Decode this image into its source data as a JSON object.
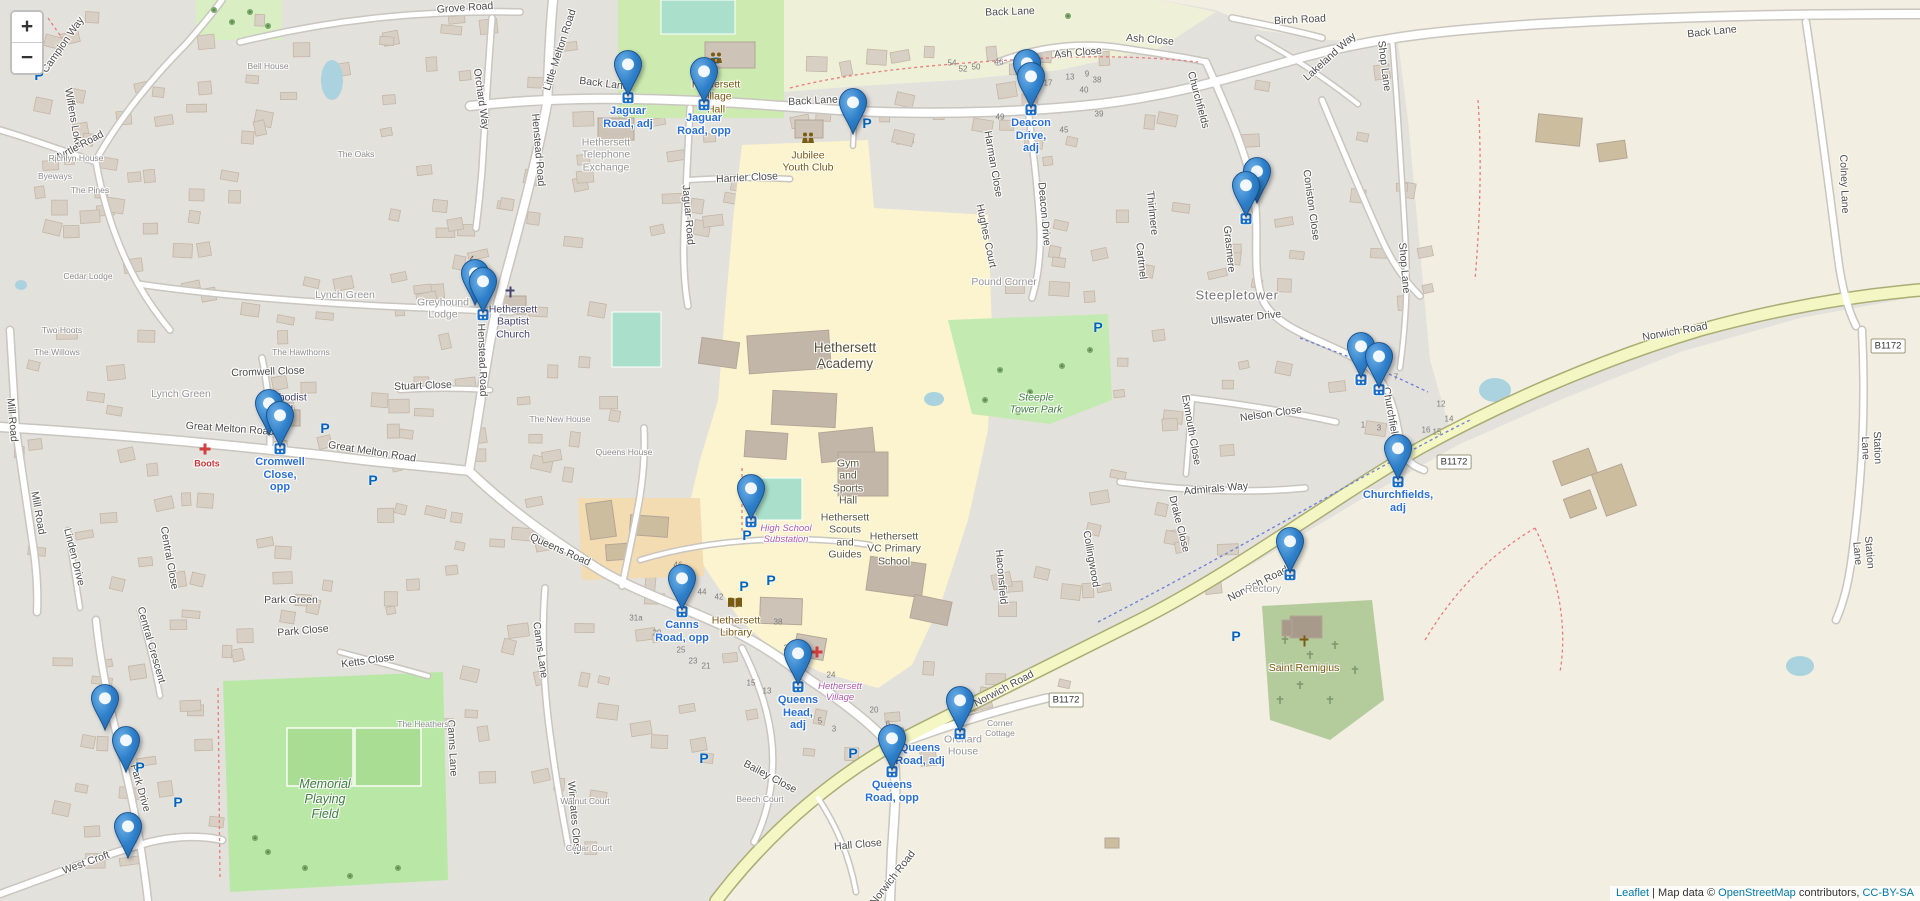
{
  "controls": {
    "zoom_in": "+",
    "zoom_out": "−"
  },
  "attribution": {
    "leaflet": "Leaflet",
    "separator": " | ",
    "prefix": "Map data © ",
    "osm": "OpenStreetMap",
    "contributors": " contributors, ",
    "license": "CC-BY-SA"
  },
  "colors": {
    "marker_blue": "#2a81cb",
    "marker_label_blue": "#2a6fd6",
    "link_blue": "#0078a8",
    "road_b_yellow": "#f4f6c3"
  },
  "markers": [
    {
      "id": "jaguar-road-adj",
      "x": 628,
      "y": 102,
      "bus": true,
      "label": "Jaguar\nRoad, adj"
    },
    {
      "id": "jaguar-road-opp",
      "x": 704,
      "y": 109,
      "bus": true,
      "label": "Jaguar\nRoad, opp"
    },
    {
      "id": "back-lane-car-park",
      "x": 853,
      "y": 140,
      "bus": false,
      "label": ""
    },
    {
      "id": "deacon-drive-rear",
      "x": 1027,
      "y": 101,
      "bus": false,
      "label": ""
    },
    {
      "id": "deacon-drive-adj",
      "x": 1031,
      "y": 114,
      "bus": true,
      "label": "Deacon\nDrive,\nadj"
    },
    {
      "id": "coniston-close-1",
      "x": 1257,
      "y": 209,
      "bus": false,
      "label": ""
    },
    {
      "id": "coniston-close-2",
      "x": 1246,
      "y": 223,
      "bus": true,
      "label": ""
    },
    {
      "id": "baptist-church-1",
      "x": 475,
      "y": 311,
      "bus": false,
      "label": ""
    },
    {
      "id": "baptist-church-2",
      "x": 483,
      "y": 319,
      "bus": true,
      "label": ""
    },
    {
      "id": "cromwell-close-rear",
      "x": 269,
      "y": 441,
      "bus": false,
      "label": ""
    },
    {
      "id": "cromwell-close-opp",
      "x": 280,
      "y": 453,
      "bus": true,
      "label": "Cromwell\nClose,\nopp"
    },
    {
      "id": "churchfields-1",
      "x": 1361,
      "y": 384,
      "bus": true,
      "label": ""
    },
    {
      "id": "churchfields-2",
      "x": 1379,
      "y": 394,
      "bus": true,
      "label": ""
    },
    {
      "id": "churchfields-adj",
      "x": 1398,
      "y": 486,
      "bus": true,
      "label": "Churchfields,\nadj"
    },
    {
      "id": "high-school",
      "x": 751,
      "y": 526,
      "bus": true,
      "label": ""
    },
    {
      "id": "canns-road-opp",
      "x": 682,
      "y": 616,
      "bus": true,
      "label": "Canns\nRoad, opp"
    },
    {
      "id": "norwich-road",
      "x": 1290,
      "y": 579,
      "bus": true,
      "label": ""
    },
    {
      "id": "queens-head-adj",
      "x": 798,
      "y": 691,
      "bus": true,
      "label": "Queens\nHead,\nadj"
    },
    {
      "id": "queens-road-adj",
      "x": 960,
      "y": 738,
      "bus": true,
      "label": "Queens\nRoad, adj",
      "lx": 920,
      "ly": 742
    },
    {
      "id": "queens-road-opp",
      "x": 892,
      "y": 776,
      "bus": true,
      "label": "Queens\nRoad, opp"
    },
    {
      "id": "park-drive-1",
      "x": 105,
      "y": 736,
      "bus": false,
      "label": ""
    },
    {
      "id": "park-drive-2",
      "x": 126,
      "y": 778,
      "bus": false,
      "label": ""
    },
    {
      "id": "west-croft",
      "x": 128,
      "y": 864,
      "bus": false,
      "label": ""
    }
  ],
  "labels": [
    {
      "t": "Grove Road",
      "x": 465,
      "y": 8,
      "r": -4,
      "c": "st"
    },
    {
      "t": "Back Lane",
      "x": 604,
      "y": 84,
      "r": 7,
      "c": "st"
    },
    {
      "t": "Back Lane",
      "x": 813,
      "y": 101,
      "r": -3,
      "c": "st"
    },
    {
      "t": "Back Lane",
      "x": 1010,
      "y": 12,
      "r": -2,
      "c": "st"
    },
    {
      "t": "Back Lane",
      "x": 1712,
      "y": 32,
      "r": -6,
      "c": "st"
    },
    {
      "t": "Campion Way",
      "x": 63,
      "y": 45,
      "r": -55,
      "c": "st"
    },
    {
      "t": "Wiffens Loke",
      "x": 73,
      "y": 118,
      "r": 80,
      "c": "st"
    },
    {
      "t": "Myrtle Road",
      "x": 78,
      "y": 147,
      "r": -28,
      "c": "st"
    },
    {
      "t": "Orchard Way",
      "x": 481,
      "y": 99,
      "r": 82,
      "c": "st"
    },
    {
      "t": "Little Melton Road",
      "x": 560,
      "y": 50,
      "r": -72,
      "c": "st"
    },
    {
      "t": "Henstead Road",
      "x": 538,
      "y": 150,
      "r": 85,
      "c": "st"
    },
    {
      "t": "Henstead Road",
      "x": 482,
      "y": 360,
      "r": 88,
      "c": "st"
    },
    {
      "t": "Jaguar Road",
      "x": 688,
      "y": 215,
      "r": 85,
      "c": "st"
    },
    {
      "t": "Harrier Close",
      "x": 747,
      "y": 178,
      "r": -3,
      "c": "st"
    },
    {
      "t": "Lynch Green",
      "x": 345,
      "y": 295,
      "r": 0,
      "c": "ar"
    },
    {
      "t": "Lynch Green",
      "x": 181,
      "y": 394,
      "r": 0,
      "c": "ar"
    },
    {
      "t": "Stuart Close",
      "x": 423,
      "y": 386,
      "r": -2,
      "c": "st"
    },
    {
      "t": "Cromwell Close",
      "x": 268,
      "y": 372,
      "r": -2,
      "c": "st"
    },
    {
      "t": "Great Melton Road",
      "x": 230,
      "y": 429,
      "r": 4,
      "c": "st"
    },
    {
      "t": "Great Melton Road",
      "x": 372,
      "y": 452,
      "r": 9,
      "c": "st"
    },
    {
      "t": "Mill Road",
      "x": 12,
      "y": 420,
      "r": 85,
      "c": "st"
    },
    {
      "t": "Mill Road",
      "x": 38,
      "y": 513,
      "r": 80,
      "c": "st"
    },
    {
      "t": "Queens Road",
      "x": 560,
      "y": 550,
      "r": 24,
      "c": "st"
    },
    {
      "t": "Canns Lane",
      "x": 540,
      "y": 650,
      "r": 82,
      "c": "st"
    },
    {
      "t": "Canns Lane",
      "x": 452,
      "y": 748,
      "r": 87,
      "c": "st"
    },
    {
      "t": "Ketts Close",
      "x": 368,
      "y": 661,
      "r": -8,
      "c": "st"
    },
    {
      "t": "Park Green",
      "x": 291,
      "y": 600,
      "r": 0,
      "c": "st"
    },
    {
      "t": "Park Close",
      "x": 303,
      "y": 631,
      "r": -5,
      "c": "st"
    },
    {
      "t": "Central Crescent",
      "x": 151,
      "y": 645,
      "r": 74,
      "c": "st"
    },
    {
      "t": "Central Close",
      "x": 169,
      "y": 558,
      "r": 80,
      "c": "st"
    },
    {
      "t": "Linden Drive",
      "x": 74,
      "y": 557,
      "r": 76,
      "c": "st"
    },
    {
      "t": "Park Drive",
      "x": 140,
      "y": 788,
      "r": 74,
      "c": "st"
    },
    {
      "t": "West Croft",
      "x": 86,
      "y": 863,
      "r": -20,
      "c": "st"
    },
    {
      "t": "Bailey Close",
      "x": 770,
      "y": 777,
      "r": 28,
      "c": "st"
    },
    {
      "t": "Hall Close",
      "x": 858,
      "y": 845,
      "r": -5,
      "c": "st"
    },
    {
      "t": "Wingates Close",
      "x": 574,
      "y": 818,
      "r": 85,
      "c": "st"
    },
    {
      "t": "Norwich Road",
      "x": 893,
      "y": 878,
      "r": -52,
      "c": "st"
    },
    {
      "t": "Norwich Road",
      "x": 1004,
      "y": 689,
      "r": -28,
      "c": "st"
    },
    {
      "t": "Norwich Road",
      "x": 1258,
      "y": 584,
      "r": -27,
      "c": "st"
    },
    {
      "t": "Norwich Road",
      "x": 1675,
      "y": 332,
      "r": -10,
      "c": "st"
    },
    {
      "t": "Churchfields",
      "x": 1198,
      "y": 100,
      "r": 75,
      "c": "st"
    },
    {
      "t": "Churchfields",
      "x": 1391,
      "y": 416,
      "r": 80,
      "c": "st"
    },
    {
      "t": "Coniston Close",
      "x": 1311,
      "y": 205,
      "r": 82,
      "c": "st"
    },
    {
      "t": "Lakeland Way",
      "x": 1330,
      "y": 57,
      "r": -42,
      "c": "st"
    },
    {
      "t": "Birch Road",
      "x": 1300,
      "y": 20,
      "r": -3,
      "c": "st"
    },
    {
      "t": "Ash Close",
      "x": 1078,
      "y": 53,
      "r": -5,
      "c": "st"
    },
    {
      "t": "Ash Close",
      "x": 1150,
      "y": 40,
      "r": 5,
      "c": "st"
    },
    {
      "t": "Shop Lane",
      "x": 1384,
      "y": 66,
      "r": 83,
      "c": "st"
    },
    {
      "t": "Shop Lane",
      "x": 1404,
      "y": 268,
      "r": 85,
      "c": "st"
    },
    {
      "t": "Station Lane",
      "x": 1871,
      "y": 448,
      "r": 88,
      "c": "st"
    },
    {
      "t": "Station Lane",
      "x": 1863,
      "y": 553,
      "r": 85,
      "c": "st"
    },
    {
      "t": "Colney Lane",
      "x": 1844,
      "y": 184,
      "r": 88,
      "c": "st"
    },
    {
      "t": "Harman Close",
      "x": 993,
      "y": 164,
      "r": 80,
      "c": "st"
    },
    {
      "t": "Hughes Court",
      "x": 986,
      "y": 236,
      "r": 78,
      "c": "st"
    },
    {
      "t": "Deacon Drive",
      "x": 1044,
      "y": 214,
      "r": 85,
      "c": "st"
    },
    {
      "t": "Cartmel",
      "x": 1141,
      "y": 261,
      "r": 84,
      "c": "st"
    },
    {
      "t": "Thirlmere",
      "x": 1152,
      "y": 213,
      "r": 84,
      "c": "st"
    },
    {
      "t": "Grasmere",
      "x": 1229,
      "y": 249,
      "r": 84,
      "c": "st"
    },
    {
      "t": "Ullswater Drive",
      "x": 1246,
      "y": 318,
      "r": -6,
      "c": "st"
    },
    {
      "t": "Nelson Close",
      "x": 1271,
      "y": 414,
      "r": -8,
      "c": "st"
    },
    {
      "t": "Admirals Way",
      "x": 1216,
      "y": 489,
      "r": -5,
      "c": "st"
    },
    {
      "t": "Exmouth Close",
      "x": 1191,
      "y": 430,
      "r": 80,
      "c": "st"
    },
    {
      "t": "Drake Close",
      "x": 1179,
      "y": 524,
      "r": 76,
      "c": "st"
    },
    {
      "t": "Collingwood",
      "x": 1091,
      "y": 559,
      "r": 80,
      "c": "st"
    },
    {
      "t": "Haconsfield",
      "x": 1001,
      "y": 577,
      "r": 85,
      "c": "st"
    },
    {
      "t": "Rectory",
      "x": 1263,
      "y": 589,
      "r": 0,
      "c": "ar"
    },
    {
      "t": "Pound Corner",
      "x": 1004,
      "y": 282,
      "r": 0,
      "c": "ar"
    },
    {
      "t": "Steepletower",
      "x": 1237,
      "y": 295,
      "r": 0,
      "c": "loc"
    },
    {
      "t": "Bell House",
      "x": 268,
      "y": 66,
      "r": 0,
      "c": "hn"
    },
    {
      "t": "The Oaks",
      "x": 356,
      "y": 154,
      "r": 0,
      "c": "hn"
    },
    {
      "t": "Richlyn House",
      "x": 76,
      "y": 158,
      "r": 0,
      "c": "hn"
    },
    {
      "t": "The Pines",
      "x": 90,
      "y": 190,
      "r": 0,
      "c": "hn"
    },
    {
      "t": "Byeways",
      "x": 55,
      "y": 176,
      "r": 0,
      "c": "hn"
    },
    {
      "t": "Cedar Lodge",
      "x": 88,
      "y": 276,
      "r": 0,
      "c": "hn"
    },
    {
      "t": "Two Hoots",
      "x": 62,
      "y": 330,
      "r": 0,
      "c": "hn"
    },
    {
      "t": "The Willows",
      "x": 57,
      "y": 352,
      "r": 0,
      "c": "hn"
    },
    {
      "t": "The Hawthorns",
      "x": 301,
      "y": 352,
      "r": 0,
      "c": "hn"
    },
    {
      "t": "Greyhound\nLodge",
      "x": 443,
      "y": 309,
      "r": 0,
      "c": "ar"
    },
    {
      "t": "The New House",
      "x": 560,
      "y": 419,
      "r": 0,
      "c": "hn"
    },
    {
      "t": "Queens House",
      "x": 624,
      "y": 452,
      "r": 0,
      "c": "hn"
    },
    {
      "t": "Corner\nCottage",
      "x": 1000,
      "y": 728,
      "r": 0,
      "c": "hn"
    },
    {
      "t": "Orchard\nHouse",
      "x": 963,
      "y": 746,
      "r": 0,
      "c": "ar"
    },
    {
      "t": "The Heathers",
      "x": 423,
      "y": 724,
      "r": 0,
      "c": "hn"
    },
    {
      "t": "Walnut Court",
      "x": 585,
      "y": 801,
      "r": 0,
      "c": "hn"
    },
    {
      "t": "Cedar Court",
      "x": 589,
      "y": 848,
      "r": 0,
      "c": "hn"
    },
    {
      "t": "Beech Court",
      "x": 760,
      "y": 799,
      "r": 0,
      "c": "hn"
    },
    {
      "t": "Hethersett\nVillage\nHall",
      "x": 716,
      "y": 97,
      "r": 0,
      "c": "poi"
    },
    {
      "t": "Jubilee\nYouth Club",
      "x": 808,
      "y": 162,
      "r": 0,
      "c": "poi"
    },
    {
      "t": "Hethersett\nTelephone\nExchange",
      "x": 606,
      "y": 155,
      "r": 0,
      "c": "ar"
    },
    {
      "t": "Hethersett\nBaptist\nChurch",
      "x": 513,
      "y": 322,
      "r": 0,
      "c": "chu"
    },
    {
      "t": "Methodist\nHall",
      "x": 284,
      "y": 404,
      "r": 0,
      "c": "chu"
    },
    {
      "t": "Saint Remigius",
      "x": 1304,
      "y": 668,
      "r": 0,
      "c": "poi"
    },
    {
      "t": "Hethersett\nLibrary",
      "x": 736,
      "y": 627,
      "r": 0,
      "c": "poi"
    },
    {
      "t": "Boots",
      "x": 207,
      "y": 464,
      "r": 0,
      "c": "med"
    },
    {
      "t": "Hethersett\nAcademy",
      "x": 845,
      "y": 356,
      "r": 0,
      "c": "schbig"
    },
    {
      "t": "Gym\nand\nSports\nHall",
      "x": 848,
      "y": 482,
      "r": 0,
      "c": "sch"
    },
    {
      "t": "Hethersett\nScouts\nand\nGuides",
      "x": 845,
      "y": 536,
      "r": 0,
      "c": "sch"
    },
    {
      "t": "Hethersett\nVC Primary\nSchool",
      "x": 894,
      "y": 549,
      "r": 0,
      "c": "sch"
    },
    {
      "t": "Steeple\nTower Park",
      "x": 1036,
      "y": 404,
      "r": 0,
      "c": "park"
    },
    {
      "t": "Memorial\nPlaying\nField",
      "x": 325,
      "y": 799,
      "r": 0,
      "c": "parkbig"
    },
    {
      "t": "High School\nSubstation",
      "x": 786,
      "y": 534,
      "r": 0,
      "c": "pow"
    },
    {
      "t": "Hethersett\nVillage",
      "x": 840,
      "y": 692,
      "r": 0,
      "c": "pow"
    }
  ],
  "numbers": [
    [
      "31a",
      636,
      618
    ],
    [
      "29",
      657,
      633
    ],
    [
      "25",
      681,
      650
    ],
    [
      "23",
      693,
      661
    ],
    [
      "21",
      706,
      666
    ],
    [
      "34",
      788,
      648
    ],
    [
      "24",
      831,
      675
    ],
    [
      "20",
      874,
      710
    ],
    [
      "15",
      751,
      683
    ],
    [
      "13",
      767,
      691
    ],
    [
      "5",
      820,
      721
    ],
    [
      "3",
      834,
      729
    ],
    [
      "6",
      888,
      724
    ],
    [
      "2",
      902,
      731
    ],
    [
      "54",
      952,
      63
    ],
    [
      "52",
      963,
      69
    ],
    [
      "50",
      976,
      67
    ],
    [
      "46",
      999,
      62
    ],
    [
      "21",
      1034,
      59
    ],
    [
      "17",
      1048,
      83
    ],
    [
      "13",
      1070,
      77
    ],
    [
      "9",
      1087,
      74
    ],
    [
      "38",
      1097,
      80
    ],
    [
      "40",
      1084,
      90
    ],
    [
      "49",
      1000,
      117
    ],
    [
      "45",
      1064,
      130
    ],
    [
      "39",
      1099,
      114
    ],
    [
      "44",
      702,
      592
    ],
    [
      "42",
      719,
      597
    ],
    [
      "38",
      778,
      622
    ],
    [
      "46",
      678,
      565
    ],
    [
      "7",
      1396,
      377
    ],
    [
      "12",
      1441,
      404
    ],
    [
      "14",
      1449,
      419
    ],
    [
      "16",
      1426,
      430
    ],
    [
      "15",
      1437,
      432
    ],
    [
      "1",
      1363,
      425
    ],
    [
      "3",
      1379,
      428
    ]
  ],
  "road_badges": [
    {
      "t": "B1172",
      "x": 1454,
      "y": 462
    },
    {
      "t": "B1172",
      "x": 1066,
      "y": 700
    },
    {
      "t": "B1172",
      "x": 1888,
      "y": 346
    }
  ],
  "parking": [
    [
      39,
      75
    ],
    [
      717,
      62
    ],
    [
      867,
      123
    ],
    [
      1098,
      327
    ],
    [
      325,
      428
    ],
    [
      373,
      480
    ],
    [
      747,
      535
    ],
    [
      744,
      586
    ],
    [
      771,
      580
    ],
    [
      704,
      758
    ],
    [
      140,
      767
    ],
    [
      178,
      802
    ],
    [
      1236,
      636
    ],
    [
      853,
      753
    ]
  ],
  "poi_icons": {
    "crosses": [
      [
        510,
        292
      ],
      [
        287,
        417
      ]
    ],
    "cross_remigius": [
      1304,
      641
    ],
    "crescent": [
      475,
      261
    ],
    "medical": [
      [
        817,
        652
      ],
      [
        205,
        449
      ]
    ],
    "book": [
      735,
      605
    ],
    "people": [
      [
        716,
        60
      ],
      [
        808,
        140
      ]
    ]
  }
}
